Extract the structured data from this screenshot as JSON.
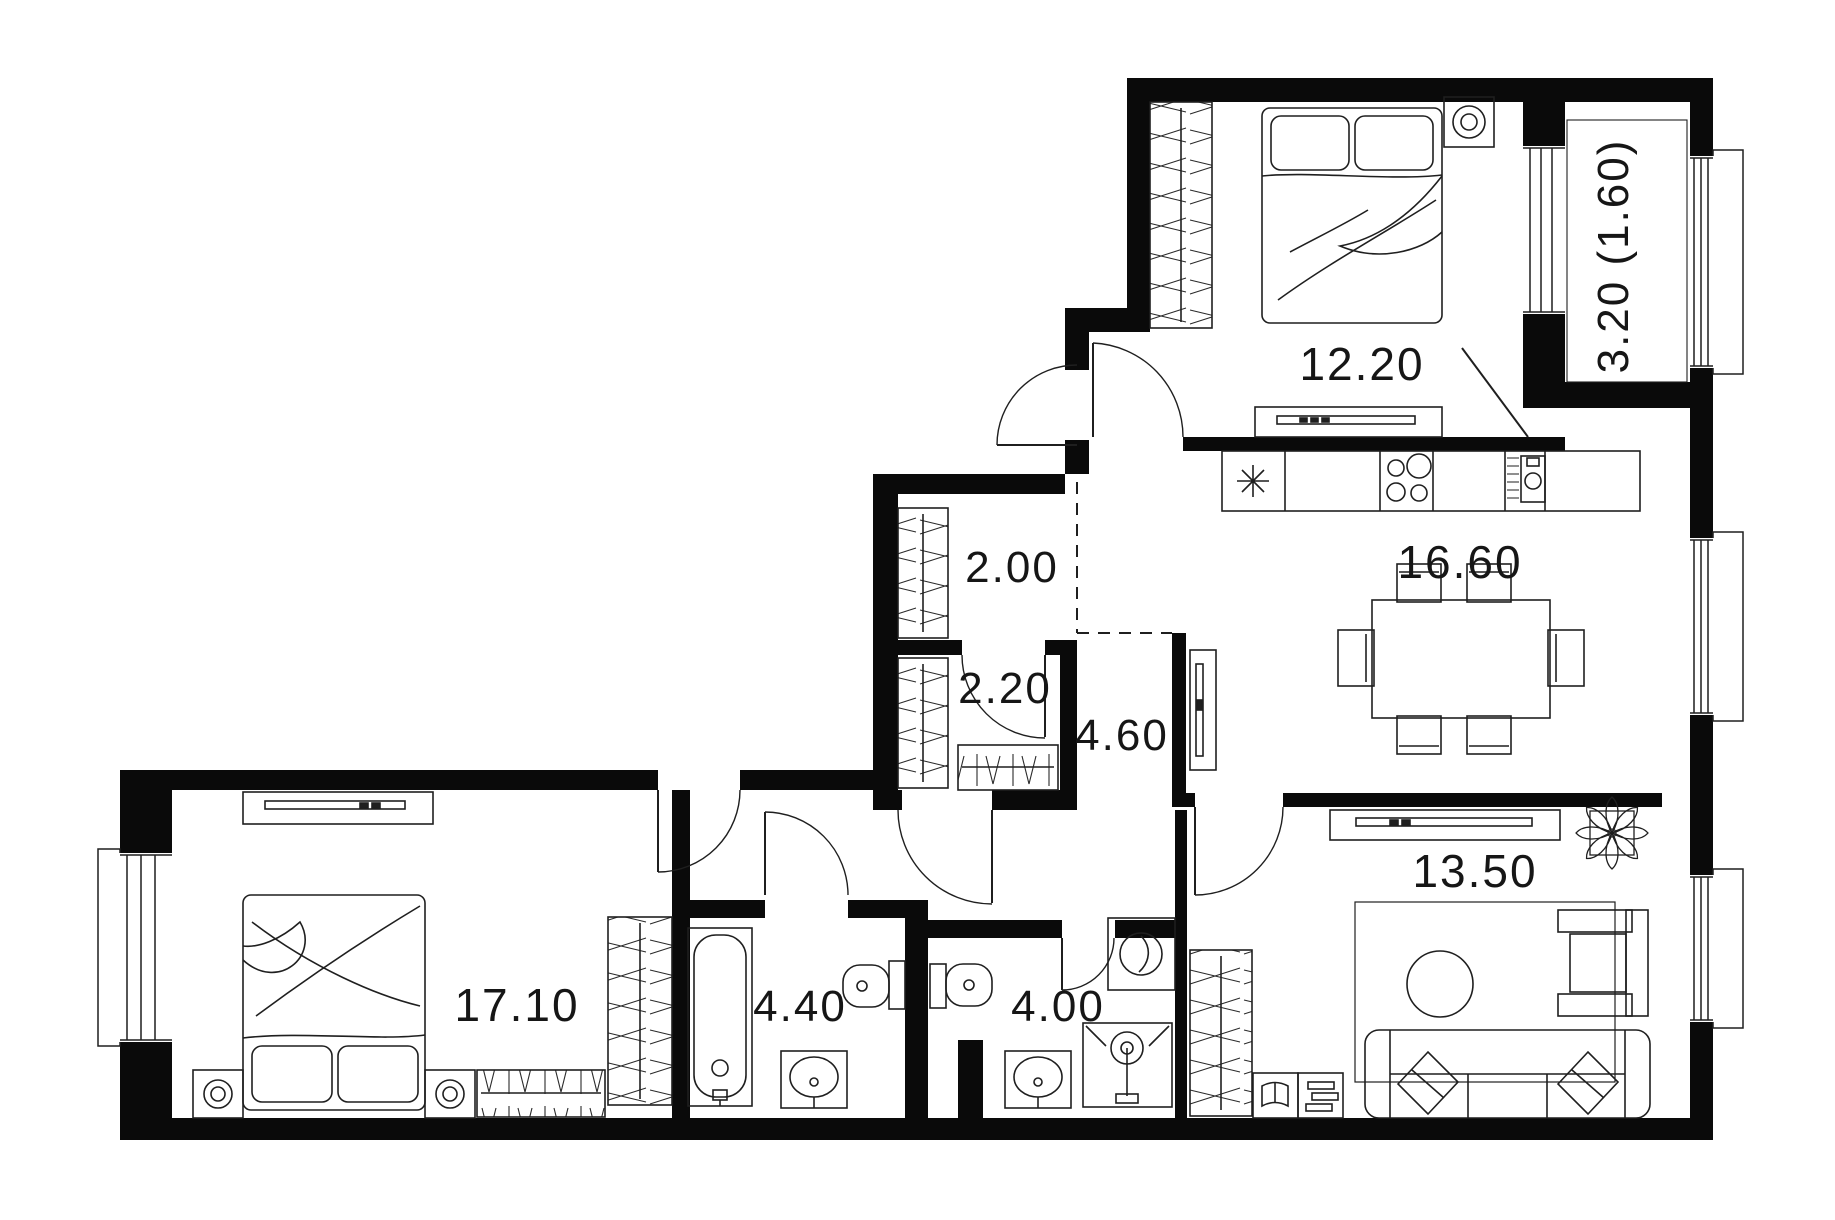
{
  "floorplan": {
    "type": "apartment-floor-plan",
    "colors": {
      "wall": "#0a0a0a",
      "line": "#1f1f1f",
      "background": "#ffffff",
      "text": "#161616"
    },
    "rooms": [
      {
        "name": "bedroom-top",
        "area_label": "12.20",
        "furniture": [
          "wardrobe",
          "double-bed",
          "wall-lamp",
          "dresser"
        ]
      },
      {
        "name": "balcony",
        "area_label": "3.20 (1.60)",
        "furniture": []
      },
      {
        "name": "hallway",
        "area_label": "2.00",
        "furniture": [
          "wardrobe"
        ]
      },
      {
        "name": "kitchen-dining",
        "area_label": "16.60",
        "furniture": [
          "fridge",
          "kitchen-counter",
          "stove",
          "kitchen-sink",
          "dining-table",
          "chairs",
          "tv-console"
        ]
      },
      {
        "name": "closet",
        "area_label": "2.20",
        "furniture": [
          "wardrobe",
          "shoe-rack"
        ]
      },
      {
        "name": "corridor",
        "area_label": "4.60",
        "furniture": []
      },
      {
        "name": "bedroom-left",
        "area_label": "17.10",
        "furniture": [
          "tv-console",
          "double-bed",
          "nightstand",
          "nightstand",
          "bench",
          "wardrobe"
        ]
      },
      {
        "name": "bathroom",
        "area_label": "4.40",
        "furniture": [
          "bathtub",
          "toilet",
          "washbasin"
        ]
      },
      {
        "name": "wc-shower",
        "area_label": "4.00",
        "furniture": [
          "toilet",
          "washing-machine",
          "washbasin",
          "shower"
        ]
      },
      {
        "name": "living-room",
        "area_label": "13.50",
        "furniture": [
          "tv-console",
          "plant",
          "wardrobe",
          "bookshelf",
          "rug",
          "coffee-table",
          "sofa",
          "armchair"
        ]
      }
    ]
  }
}
